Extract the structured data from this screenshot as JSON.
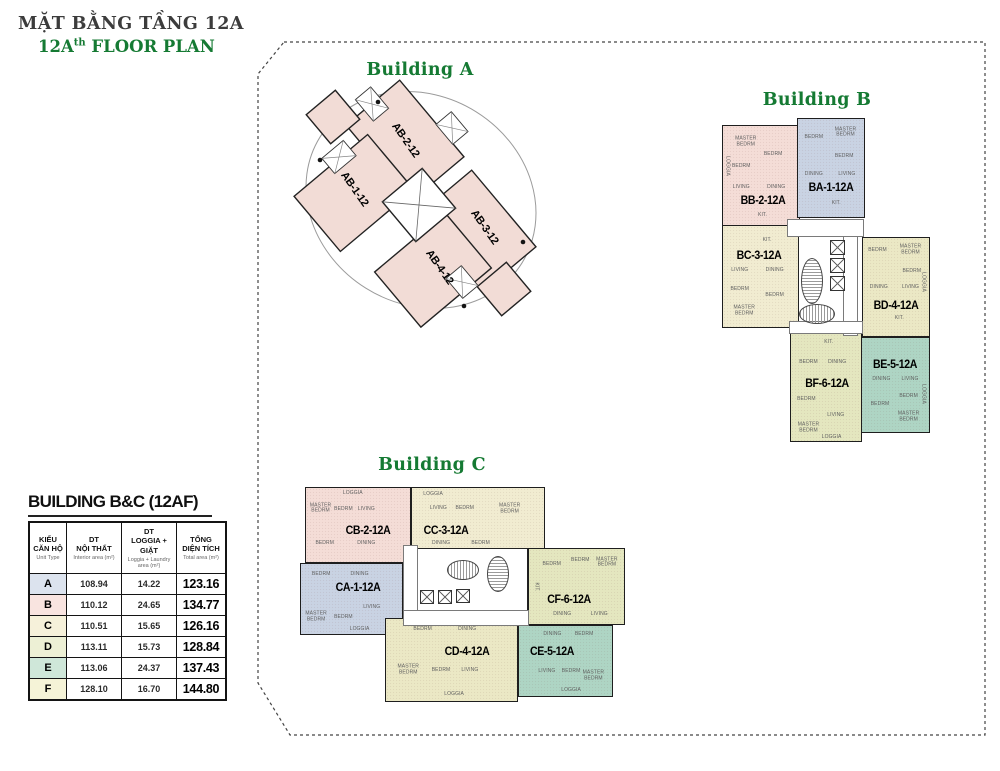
{
  "page_title": {
    "line1": "MẶT BẰNG TẦNG 12A",
    "line2_prefix": "12A",
    "line2_sup": "th",
    "line2_rest": " FLOOR PLAN"
  },
  "colors": {
    "heading_green": "#157a33",
    "title_gray": "#3c3c3c",
    "wall": "#1e1e1e",
    "building_a_pink": "#f2dcd6",
    "unit_1_blue": "#c9d3e3",
    "unit_2_pink": "#f4ddd7",
    "unit_3_cream": "#f1ecd1",
    "unit_4_yellow": "#ebe8c5",
    "unit_5_teal": "#aed5c4",
    "unit_6_green": "#e4e7bf"
  },
  "buildings": {
    "a": {
      "heading": "Building A",
      "units": [
        {
          "id": "AB1",
          "label": "AB-1-12"
        },
        {
          "id": "AB2",
          "label": "AB-2-12"
        },
        {
          "id": "AB3",
          "label": "AB-3-12"
        },
        {
          "id": "AB4",
          "label": "AB-4-12"
        }
      ]
    },
    "b": {
      "heading": "Building B",
      "units": [
        {
          "id": "BB",
          "label": "BB-2-12A",
          "color": "#f4ddd7",
          "rooms": [
            "MASTER BEDRM",
            "BEDRM",
            "BEDRM",
            "LIVING",
            "DINING",
            "KIT.",
            "LOGGIA"
          ]
        },
        {
          "id": "BA",
          "label": "BA-1-12A",
          "color": "#c9d3e3",
          "rooms": [
            "BEDRM",
            "MASTER BEDRM",
            "BEDRM",
            "DINING",
            "LIVING",
            "KIT."
          ]
        },
        {
          "id": "BC",
          "label": "BC-3-12A",
          "color": "#f1ecd1",
          "rooms": [
            "LIVING",
            "DINING",
            "BEDRM",
            "BEDRM",
            "MASTER BEDRM",
            "KIT."
          ]
        },
        {
          "id": "BD",
          "label": "BD-4-12A",
          "color": "#ebe8c5",
          "rooms": [
            "BEDRM",
            "MASTER BEDRM",
            "BEDRM",
            "DINING",
            "LIVING",
            "KIT.",
            "LOGGIA"
          ]
        },
        {
          "id": "BE",
          "label": "BE-5-12A",
          "color": "#aed5c4",
          "rooms": [
            "DINING",
            "LIVING",
            "BEDRM",
            "BEDRM",
            "MASTER BEDRM",
            "LOGGIA"
          ]
        },
        {
          "id": "BF",
          "label": "BF-6-12A",
          "color": "#e4e7bf",
          "rooms": [
            "KIT.",
            "BEDRM",
            "DINING",
            "BEDRM",
            "LIVING",
            "MASTER BEDRM",
            "LOGGIA"
          ]
        }
      ]
    },
    "c": {
      "heading": "Building C",
      "units": [
        {
          "id": "CB",
          "label": "CB-2-12A",
          "color": "#f4ddd7",
          "rooms": [
            "LOGGIA",
            "MASTER BEDRM",
            "BEDRM",
            "LIVING",
            "BEDRM",
            "DINING"
          ]
        },
        {
          "id": "CC",
          "label": "CC-3-12A",
          "color": "#f1ecd1",
          "rooms": [
            "LOGGIA",
            "LIVING",
            "BEDRM",
            "MASTER BEDRM",
            "DINING",
            "BEDRM"
          ]
        },
        {
          "id": "CA",
          "label": "CA-1-12A",
          "color": "#c9d3e3",
          "rooms": [
            "BEDRM",
            "DINING",
            "MASTER BEDRM",
            "BEDRM",
            "LIVING",
            "LOGGIA"
          ]
        },
        {
          "id": "CF",
          "label": "CF-6-12A",
          "color": "#e4e7bf",
          "rooms": [
            "BEDRM",
            "BEDRM",
            "MASTER BEDRM",
            "KIT.",
            "DINING",
            "LIVING"
          ]
        },
        {
          "id": "CD",
          "label": "CD-4-12A",
          "color": "#ebe8c5",
          "rooms": [
            "BEDRM",
            "DINING",
            "MASTER BEDRM",
            "BEDRM",
            "LIVING",
            "LOGGIA"
          ]
        },
        {
          "id": "CE",
          "label": "CE-5-12A",
          "color": "#aed5c4",
          "rooms": [
            "DINING",
            "BEDRM",
            "LIVING",
            "BEDRM",
            "MASTER BEDRM",
            "LOGGIA"
          ]
        }
      ]
    }
  },
  "legend_table": {
    "title": "BUILDING B&C (12AF)",
    "header": [
      {
        "main": "KIỂU\nCĂN HỘ",
        "sub": "Unit Type"
      },
      {
        "main": "DT\nNỘI THẤT",
        "sub": "Interior  area (m²)"
      },
      {
        "main": "DT\nLOGGIA + GIẶT",
        "sub": "Loggia + Laundry\narea (m²)"
      },
      {
        "main": "TỔNG\nDIỆN TÍCH",
        "sub": "Total area (m²)"
      }
    ],
    "rows": [
      {
        "type": "A",
        "interior": "108.94",
        "loggia": "14.22",
        "total": "123.16",
        "color": "#dce3ee"
      },
      {
        "type": "B",
        "interior": "110.12",
        "loggia": "24.65",
        "total": "134.77",
        "color": "#f9e4e0"
      },
      {
        "type": "C",
        "interior": "110.51",
        "loggia": "15.65",
        "total": "126.16",
        "color": "#f6f1da"
      },
      {
        "type": "D",
        "interior": "113.11",
        "loggia": "15.73",
        "total": "128.84",
        "color": "#edf0d5"
      },
      {
        "type": "E",
        "interior": "113.06",
        "loggia": "24.37",
        "total": "137.43",
        "color": "#cfe7d9"
      },
      {
        "type": "F",
        "interior": "128.10",
        "loggia": "16.70",
        "total": "144.80",
        "color": "#f5f3d7"
      }
    ]
  }
}
